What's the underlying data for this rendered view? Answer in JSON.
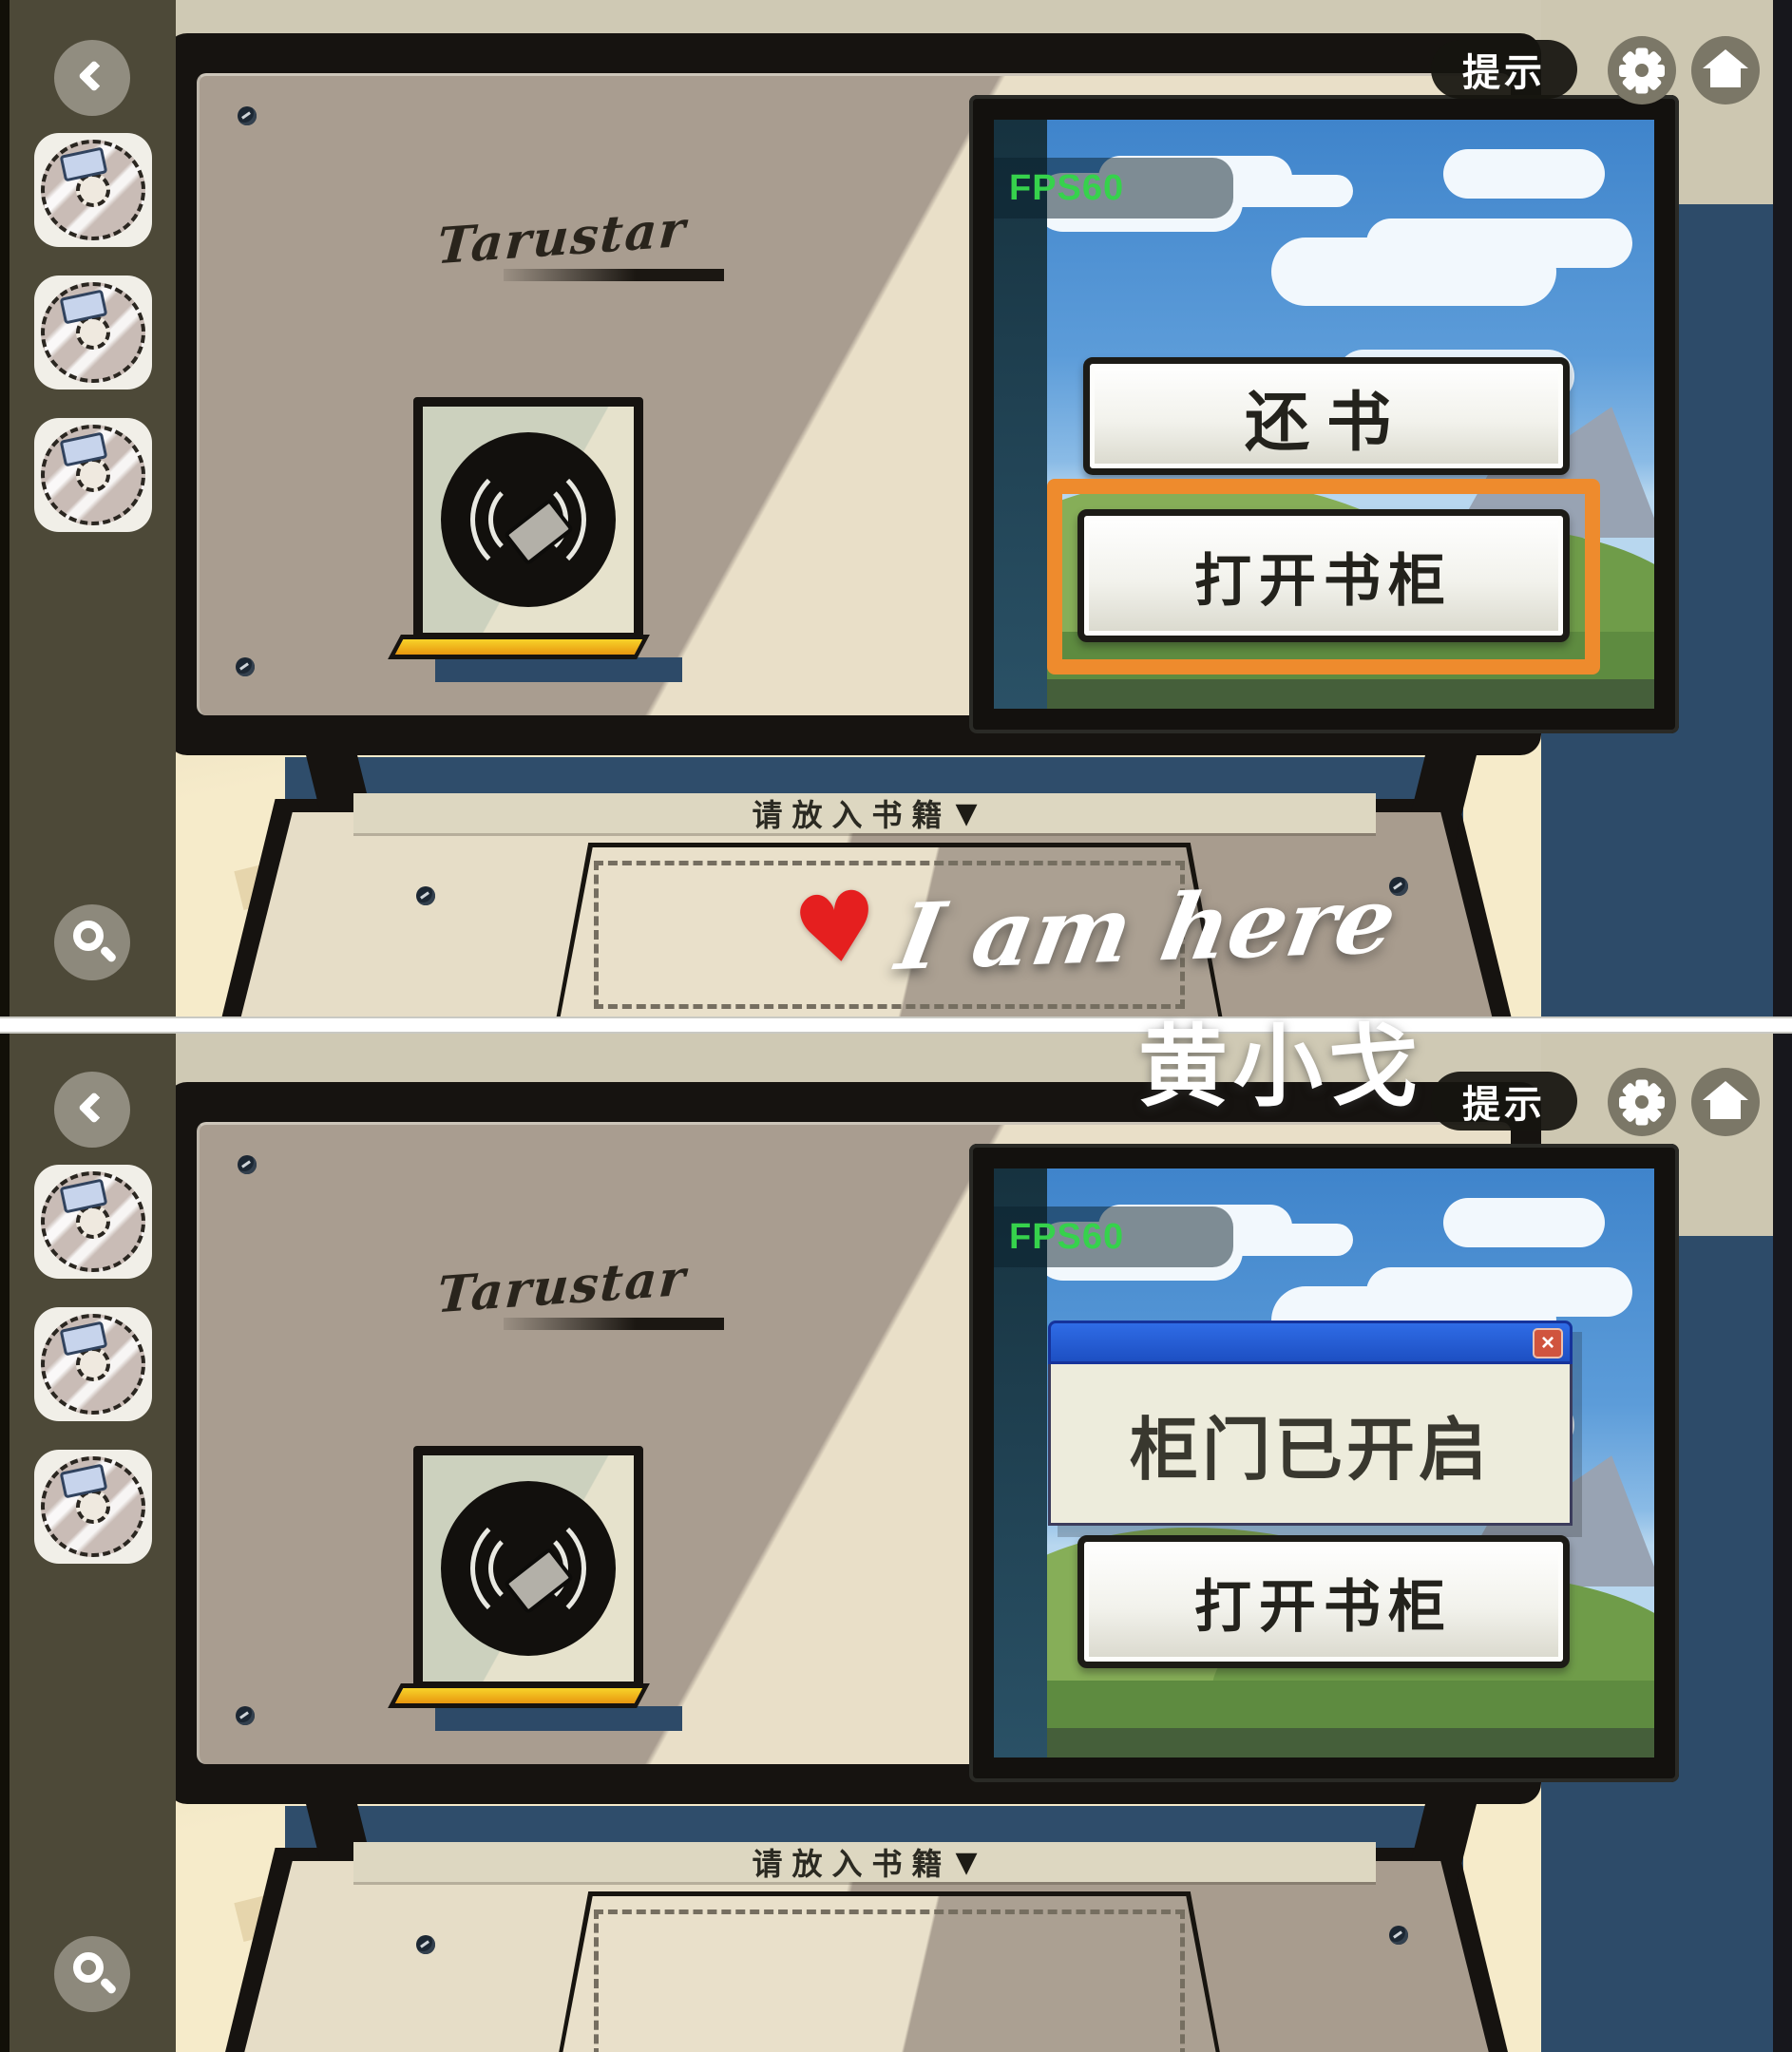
{
  "hud": {
    "hint_label": "提示",
    "back_icon": "chevron-left",
    "settings_icon": "gear",
    "home_icon": "home",
    "search_icon": "magnifier"
  },
  "sidebar": {
    "discs": [
      "disc-slot-1",
      "disc-slot-2",
      "disc-slot-3"
    ]
  },
  "machine": {
    "brand": "Tarustar",
    "slot_label": "请放入书籍",
    "slot_arrow": "▼"
  },
  "screen": {
    "fps_label": "FPS60"
  },
  "panel_top": {
    "button_return": "还书",
    "button_open": "打开书柜",
    "highlighted_button": "打开书柜"
  },
  "panel_bottom": {
    "dialog_message": "柜门已开启",
    "dialog_close": "×",
    "button_open": "打开书柜"
  },
  "annotations": {
    "heart": "♥",
    "handwriting": "I am here",
    "signature": "黄小戈"
  },
  "colors": {
    "highlight_orange": "#ee8b2d",
    "dialog_title_blue": "#2a64dc",
    "dialog_close_red": "#d0543e",
    "wall_blue": "#2d4b69",
    "sidebar_olive": "#4d4938",
    "fps_green": "#36d24c",
    "heart_red": "#e51f1f",
    "machine_panel": "#a99d90",
    "slot_yellow": "#f0b81c"
  }
}
